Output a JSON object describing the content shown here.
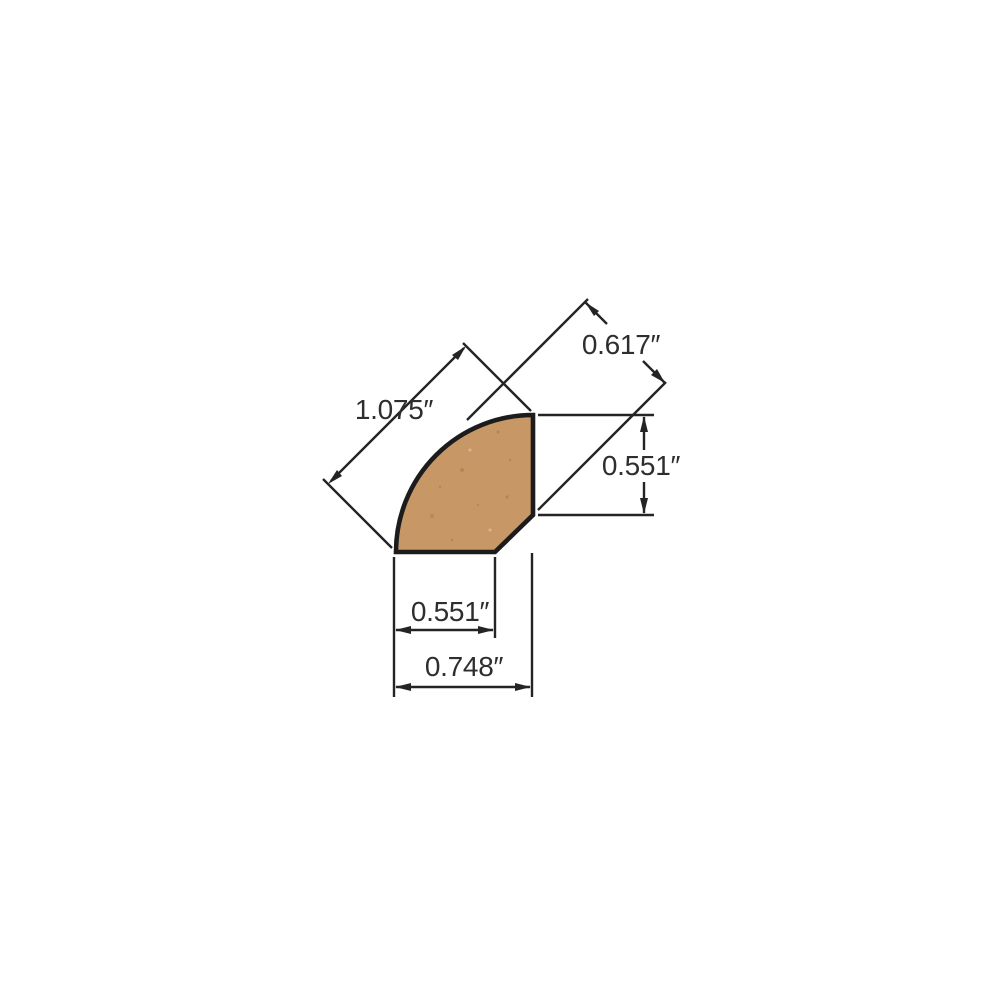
{
  "page": {
    "background": "#ffffff",
    "width": 1000,
    "height": 1000
  },
  "diagram": {
    "kind": "technical-dimension-drawing",
    "subject": "quarter-round molding cross-section with back chamfer",
    "unit": "inches",
    "profile": {
      "fill_color": "#c79866",
      "outline_color": "#1c1c1c"
    },
    "dimension_line_color": "#242424",
    "label_color": "#2e2e2e",
    "dimensions": [
      {
        "id": "face-diagonal",
        "label": "1.075″",
        "value": 1.075,
        "orientation": "diagonal-45",
        "placement": "upper-left"
      },
      {
        "id": "corner-diagonal",
        "label": "0.617″",
        "value": 0.617,
        "orientation": "diagonal-45",
        "placement": "upper-right"
      },
      {
        "id": "side-height",
        "label": "0.551″",
        "value": 0.551,
        "orientation": "vertical",
        "placement": "right"
      },
      {
        "id": "leg-width",
        "label": "0.551″",
        "value": 0.551,
        "orientation": "horizontal",
        "placement": "bottom-inner"
      },
      {
        "id": "overall-width",
        "label": "0.748″",
        "value": 0.748,
        "orientation": "horizontal",
        "placement": "bottom-outer"
      }
    ]
  }
}
